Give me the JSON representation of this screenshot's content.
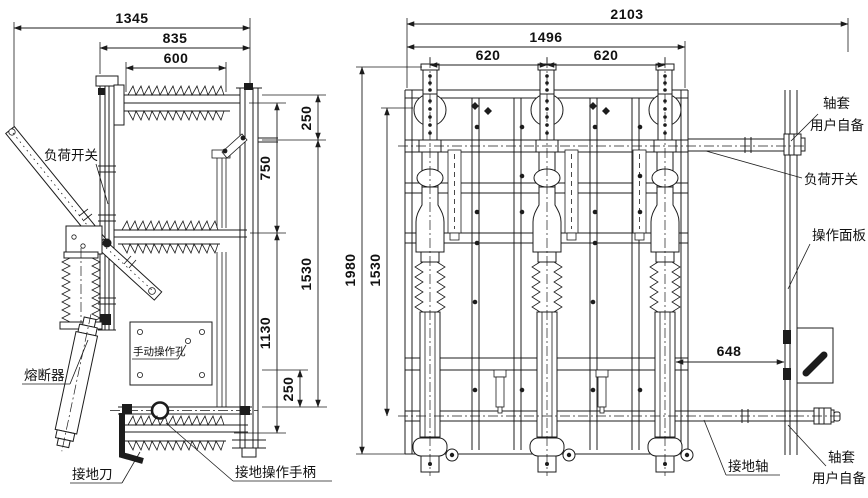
{
  "left_view": {
    "dim_1345": "1345",
    "dim_835": "835",
    "dim_600": "600",
    "dim_250_top": "250",
    "dim_750": "750",
    "dim_1530": "1530",
    "dim_1130": "1130",
    "dim_250_bottom": "250",
    "label_load_switch": "负荷开关",
    "label_fuse": "熔断器",
    "label_earth_knife": "接地刀",
    "label_earth_handle": "接地操作手柄",
    "label_manual_hole": "手动操作孔"
  },
  "right_view": {
    "dim_2103": "2103",
    "dim_1496": "1496",
    "dim_620_left": "620",
    "dim_620_right": "620",
    "dim_1980": "1980",
    "dim_1530": "1530",
    "dim_648": "648",
    "label_sleeve_top_line1": "轴套",
    "label_sleeve_top_line2": "用户自备",
    "label_load_switch": "负荷开关",
    "label_panel": "操作面板",
    "label_earth_shaft": "接地轴",
    "label_sleeve_bottom_line1": "轴套",
    "label_sleeve_bottom_line2": "用户自备"
  },
  "colors": {
    "ink": "#1c1c1c",
    "paper": "#ffffff"
  }
}
